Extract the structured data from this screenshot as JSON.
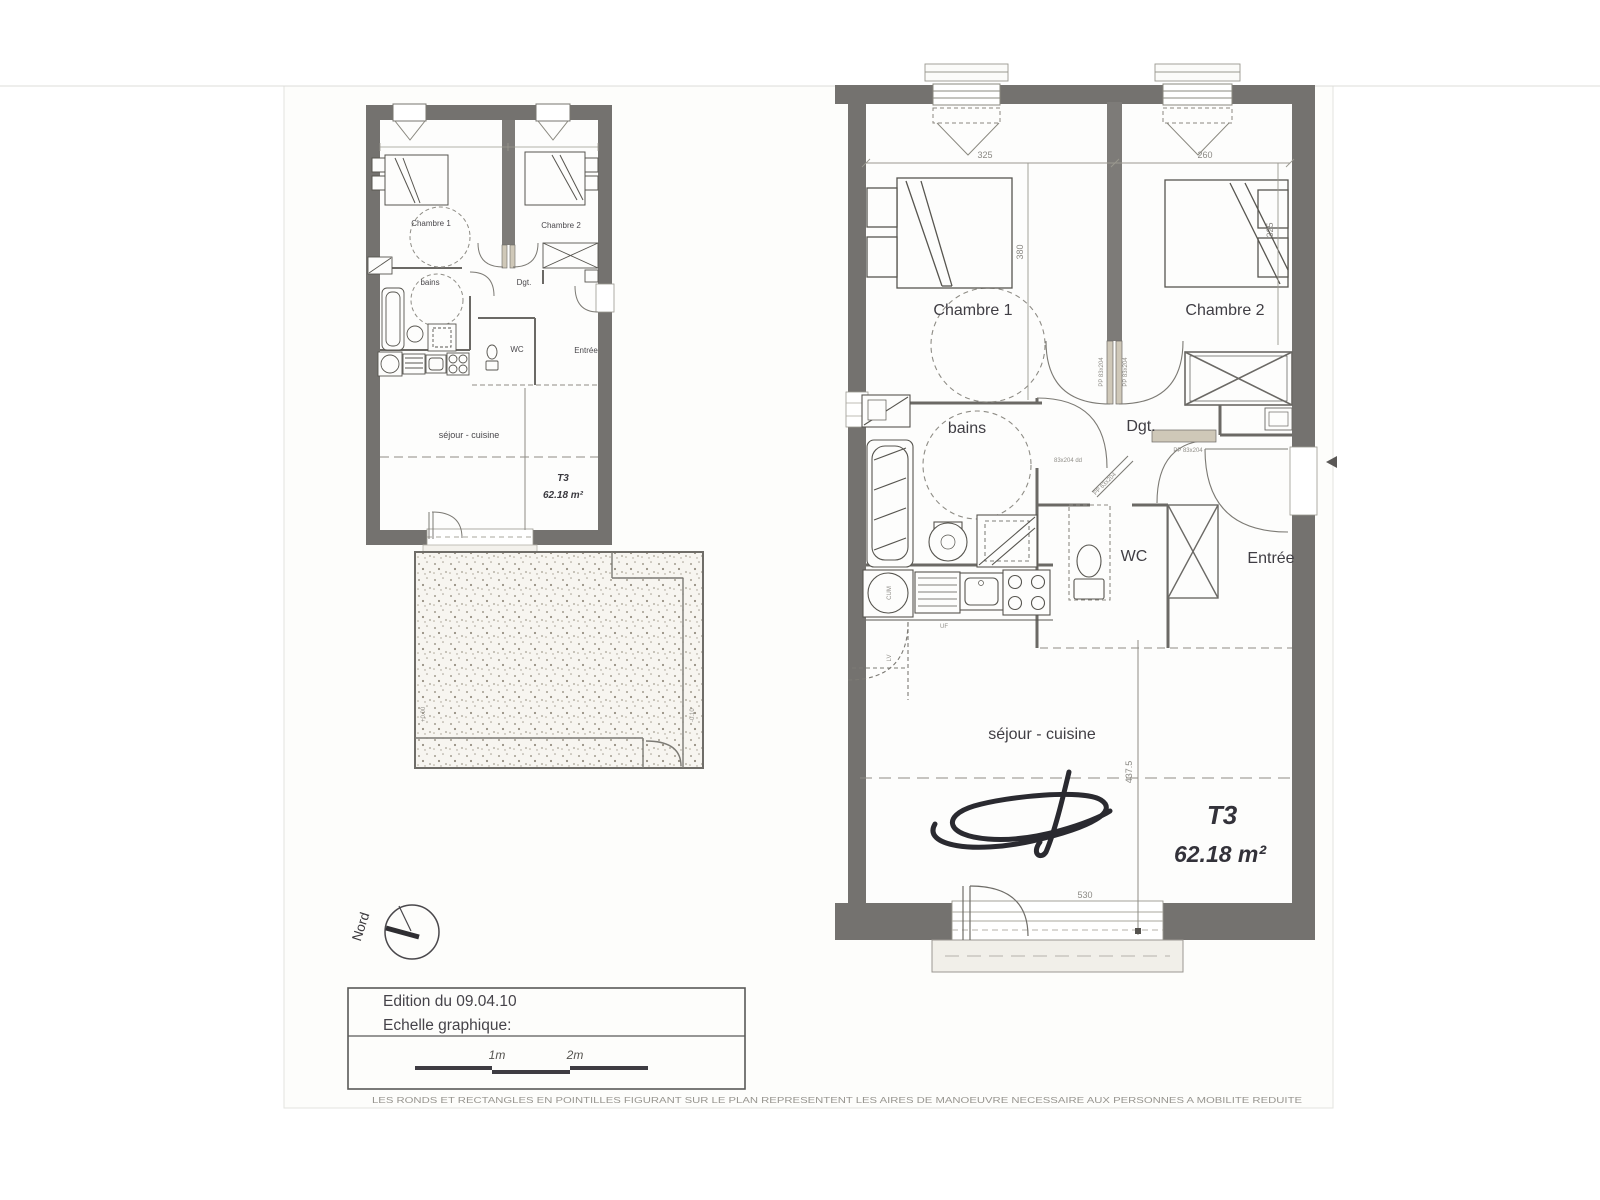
{
  "plan_large": {
    "rooms": {
      "chambre1": "Chambre 1",
      "chambre2": "Chambre 2",
      "bains": "bains",
      "dgt": "Dgt.",
      "wc": "WC",
      "entree": "Entrée",
      "sejour": "séjour - cuisine"
    },
    "unit": {
      "type": "T3",
      "area": "62.18 m²"
    },
    "dims": {
      "top_left": "325",
      "top_right": "260",
      "chambre1_depth": "380",
      "chambre2_depth": "325",
      "sejour_width": "530",
      "sejour_depth": "437.5"
    },
    "door_label": "PP 83x204",
    "door_label_diag": "PP 63x204",
    "door_label_bains": "83x204 dd",
    "appliances": {
      "cum": "CUM",
      "uf": "UF",
      "lv": "LV"
    }
  },
  "plan_small": {
    "rooms": {
      "chambre1": "Chambre 1",
      "chambre2": "Chambre 2",
      "bains": "bains",
      "dgt": "Dgt.",
      "wc": "WC",
      "entree": "Entrée",
      "sejour": "séjour - cuisine"
    },
    "unit": {
      "type": "T3",
      "area": "62.18 m²"
    },
    "terrace": {
      "level_left": "+0.00",
      "level_right": "-0.10"
    }
  },
  "north": {
    "label": "Nord"
  },
  "legend": {
    "edition": "Edition du 09.04.10",
    "scale_caption": "Echelle graphique:",
    "tick_1m": "1m",
    "tick_2m": "2m"
  },
  "footer": {
    "disclaimer": "LES RONDS ET RECTANGLES EN POINTILLES FIGURANT SUR LE PLAN REPRESENTENT LES AIRES DE MANOEUVRE NECESSAIRE AUX PERSONNES A MOBILITE REDUITE"
  }
}
